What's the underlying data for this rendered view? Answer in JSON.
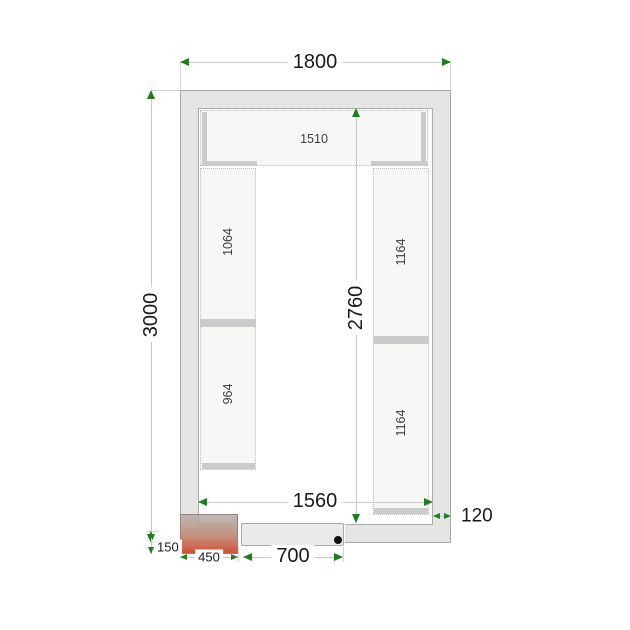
{
  "figure": {
    "type": "cold-room floor plan technical drawing",
    "dims": {
      "outer_width": "1800",
      "outer_height": "3000",
      "inner_height": "2760",
      "inner_width": "1560",
      "wall_thickness": "120",
      "unit_protrusion": "150",
      "unit_width": "450",
      "door_width": "700"
    },
    "shelves": {
      "top": "1510",
      "left_upper": "1064",
      "left_lower": "964",
      "right_upper": "1164",
      "right_lower": "1164"
    },
    "colors": {
      "dimension_arrow_green": "#1e7d1e",
      "wall_fill": "#e5e5e4",
      "shelf_fill": "#f7f7f6",
      "shelf_bar_gray": "#cbcbcb",
      "unit_gradient_top": "#b0b0ab",
      "unit_gradient_bottom": "#d14830",
      "door_fill": "#eaeaea",
      "dimension_text": "#1a1a1a"
    }
  }
}
